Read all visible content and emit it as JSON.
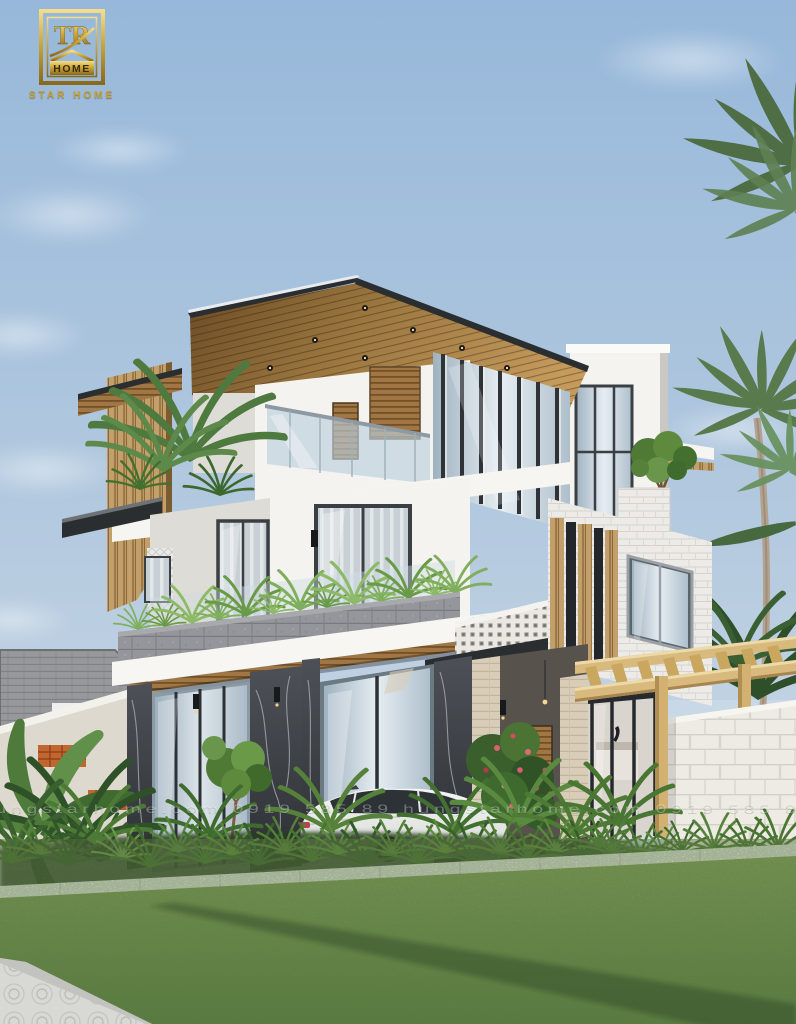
{
  "branding": {
    "logo_monogram": "TR",
    "logo_home_label": "HOME",
    "logo_caption": "STAR HOME"
  },
  "watermark": {
    "line": "hungstarhome.com    0919 585 89    hungstarhome.com    0919 585 89"
  },
  "scene": {
    "label": "Modern three-storey villa exterior render with wood-slat roof, glass balcony, marble ground floor, pergola, palm trees, white sedan, hedge and lawn"
  },
  "colors": {
    "skyTop": "#9bbbdb",
    "skyLow": "#ccd9e6",
    "cloud": "#eef3f8",
    "wallWhite": "#f4f3ef",
    "wallShade": "#dedcd6",
    "wallDim": "#c9c8c2",
    "frameDark": "#3a3f44",
    "glass": "#b7c6d2",
    "glassLight": "#dde6ed",
    "glassDark": "#8798a4",
    "fascia": "#2b2e31",
    "woodMid": "#96713c",
    "woodLight": "#c9a86e",
    "marble": "#43464b",
    "stone": "#94969b",
    "pergola": "#d9ba7e",
    "brickWhite": "#ecebe7",
    "blockFence": "#edebe4",
    "breeze": "#eae8e3",
    "greenDark": "#3c612c",
    "green": "#5d8a3c",
    "greenLight": "#7fae5c",
    "lawn": "#7c9b54",
    "lawnDark": "#5d8045",
    "pave": "#d8d8d4",
    "curb": "#eff0ee",
    "carBody": "#eaece9",
    "neighborRoof": "#97989b",
    "neighborWall": "#ded9cf",
    "ventBrick": "#c2662f",
    "gold": "#c9a133",
    "travertine": "#d8cdb8"
  }
}
